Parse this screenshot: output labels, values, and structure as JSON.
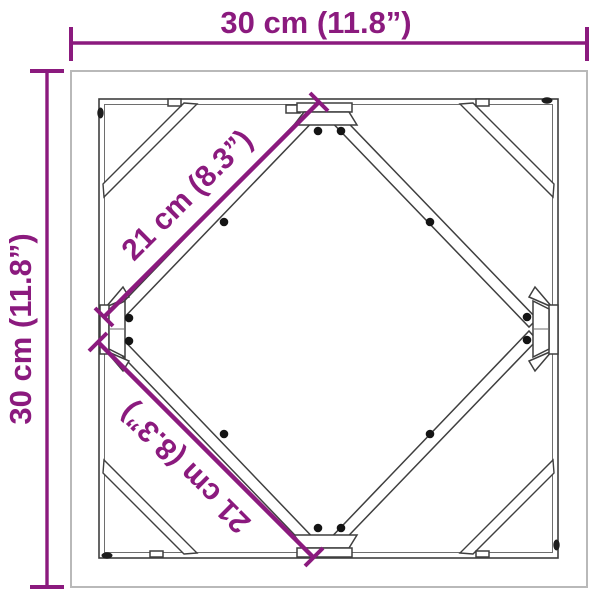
{
  "diagram": {
    "description": "Square frame top-view dimension diagram",
    "dimensions": {
      "top": "30 cm (11.8”)",
      "left": "30 cm (11.8”)",
      "diag_upper": "21 cm (8.3”)",
      "diag_lower": "21 cm (8.3”)"
    }
  },
  "colors": {
    "dimension_accent": "#8b1a7e",
    "frame_line": "#3f3f3f",
    "frame_border_light": "#b9b9b9",
    "screw_dot": "#141414",
    "background": "#ffffff"
  }
}
